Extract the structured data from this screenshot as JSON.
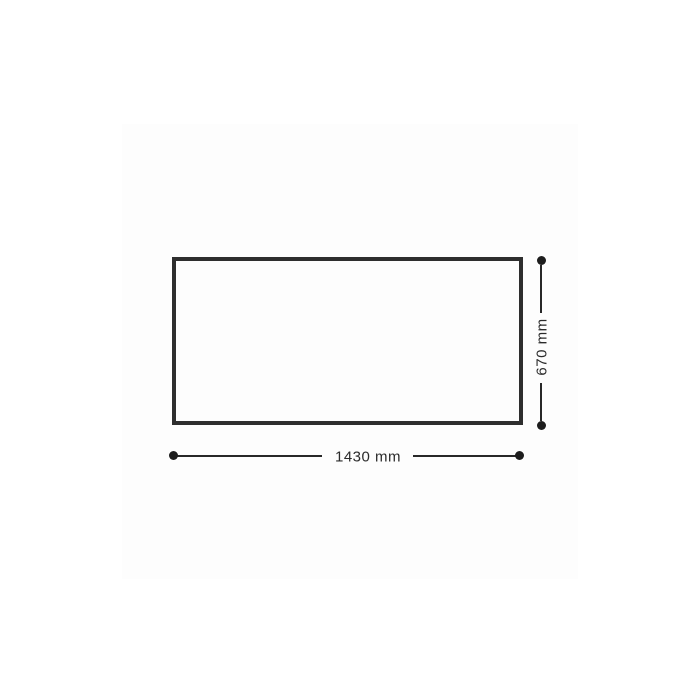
{
  "diagram": {
    "type": "dimension-drawing",
    "shape": "rectangle-outline",
    "width_label": "1430 mm",
    "height_label": "670 mm",
    "colors": {
      "outline": "#2e2e2e",
      "dimension_line": "#282828",
      "dimension_dot": "#1d1d1d",
      "label_text": "#2b2b2b",
      "canvas_background": "#fdfdfd",
      "page_background": "#ffffff"
    }
  }
}
